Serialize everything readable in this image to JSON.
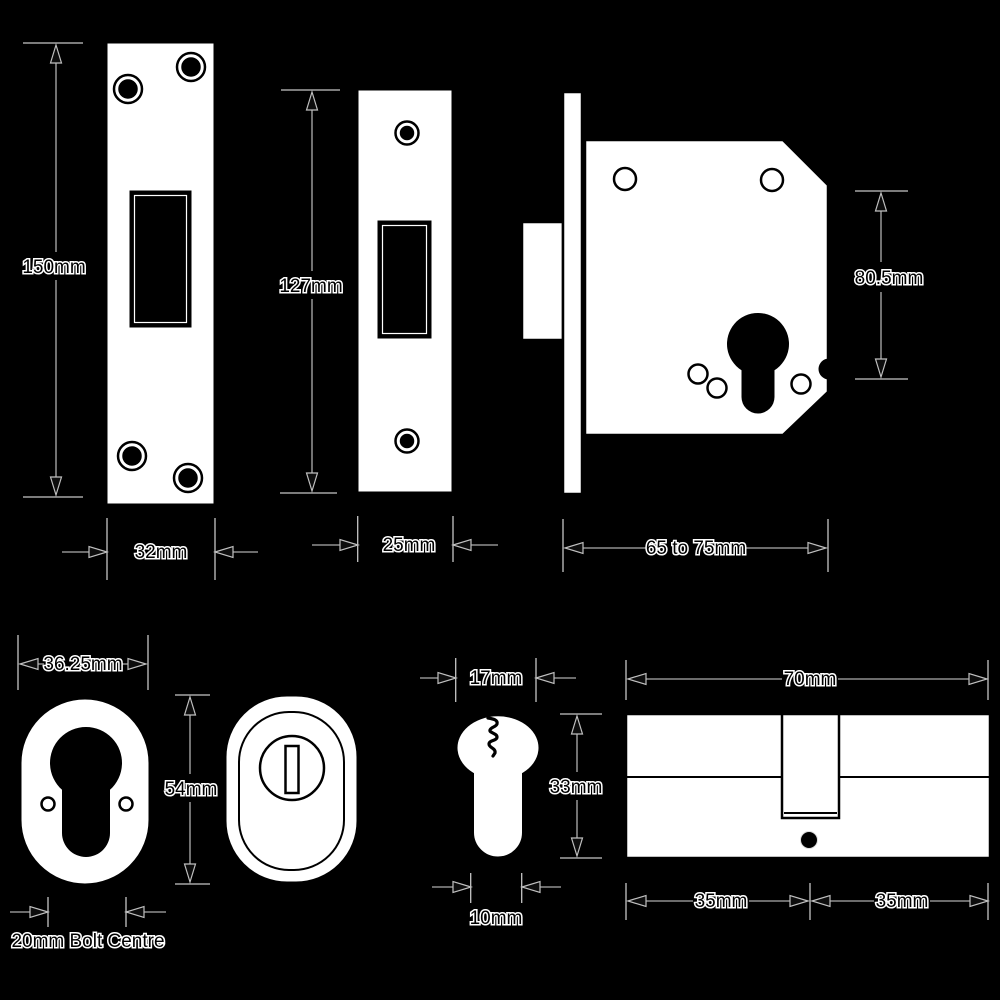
{
  "colors": {
    "background": "#000000",
    "shape_fill": "#ffffff",
    "outline": "#000000",
    "dimension_line": "#8f8f8f",
    "extension_line": "#c6c6c6",
    "label_fill": "#000000",
    "label_halo": "#ffffff"
  },
  "labels": {
    "faceplate_large_height": "150mm",
    "faceplate_large_width": "32mm",
    "faceplate_small_height": "127mm",
    "faceplate_small_width": "25mm",
    "lock_case_height": "80.5mm",
    "lock_case_width": "65 to 75mm",
    "escutcheon_width": "36.25mm",
    "escutcheon_height": "54mm",
    "escutcheon_bolt_centre": "20mm Bolt Centre",
    "cylinder_face_width": "17mm",
    "cylinder_face_height": "33mm",
    "cylinder_stem_width": "10mm",
    "cylinder_length": "70mm",
    "cylinder_half_left": "35mm",
    "cylinder_half_right": "35mm"
  }
}
